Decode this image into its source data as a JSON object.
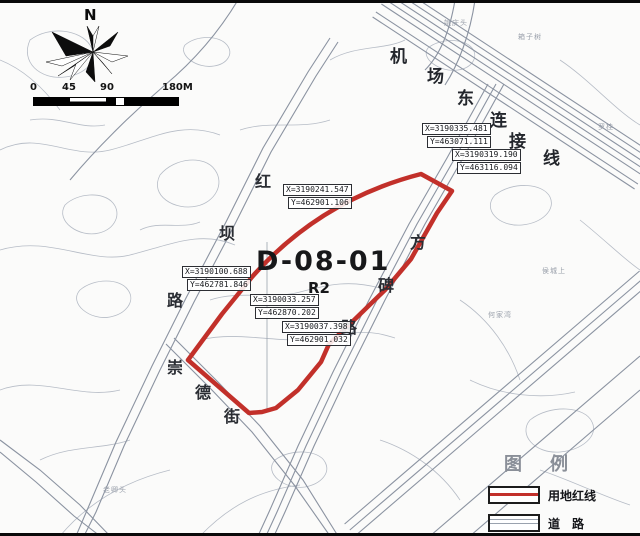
{
  "compass": {
    "north_label": "N"
  },
  "scale_bar": {
    "ticks": [
      "0",
      "45",
      "90",
      "180M"
    ]
  },
  "parcel": {
    "code": "D-08-01",
    "zone": "R2"
  },
  "roads": {
    "airport": [
      "机",
      "场",
      "东",
      "连",
      "接",
      "线"
    ],
    "hongba": [
      "红",
      "坝",
      "路"
    ],
    "fangbei": [
      "方",
      "碑",
      "路"
    ],
    "chongde": [
      "崇",
      "德",
      "街"
    ]
  },
  "coordinates": {
    "c1": {
      "x": "X=3190335.481",
      "y": "Y=463071.111"
    },
    "c2": {
      "x": "X=3190319.190",
      "y": "Y=463116.094"
    },
    "c3": {
      "x": "X=3190241.547",
      "y": "Y=462901.106"
    },
    "c4": {
      "x": "X=3190100.688",
      "y": "Y=462781.846"
    },
    "c5": {
      "x": "X=3190033.257",
      "y": "Y=462870.202"
    },
    "c6": {
      "x": "X=3190037.398",
      "y": "Y=462901.032"
    }
  },
  "place_labels": {
    "p1": "姚庆头",
    "p2": "箱子树",
    "p3": "罗桂",
    "p4": "侯城上",
    "p5": "何家湾",
    "p6": "老卿头"
  },
  "legend": {
    "title": "图例",
    "items": {
      "redline": "用地红线",
      "road": "道　路"
    }
  },
  "colors": {
    "boundary_red": "#c2302a",
    "map_line": "#b6bcc6",
    "road_line": "#8b93a1"
  }
}
